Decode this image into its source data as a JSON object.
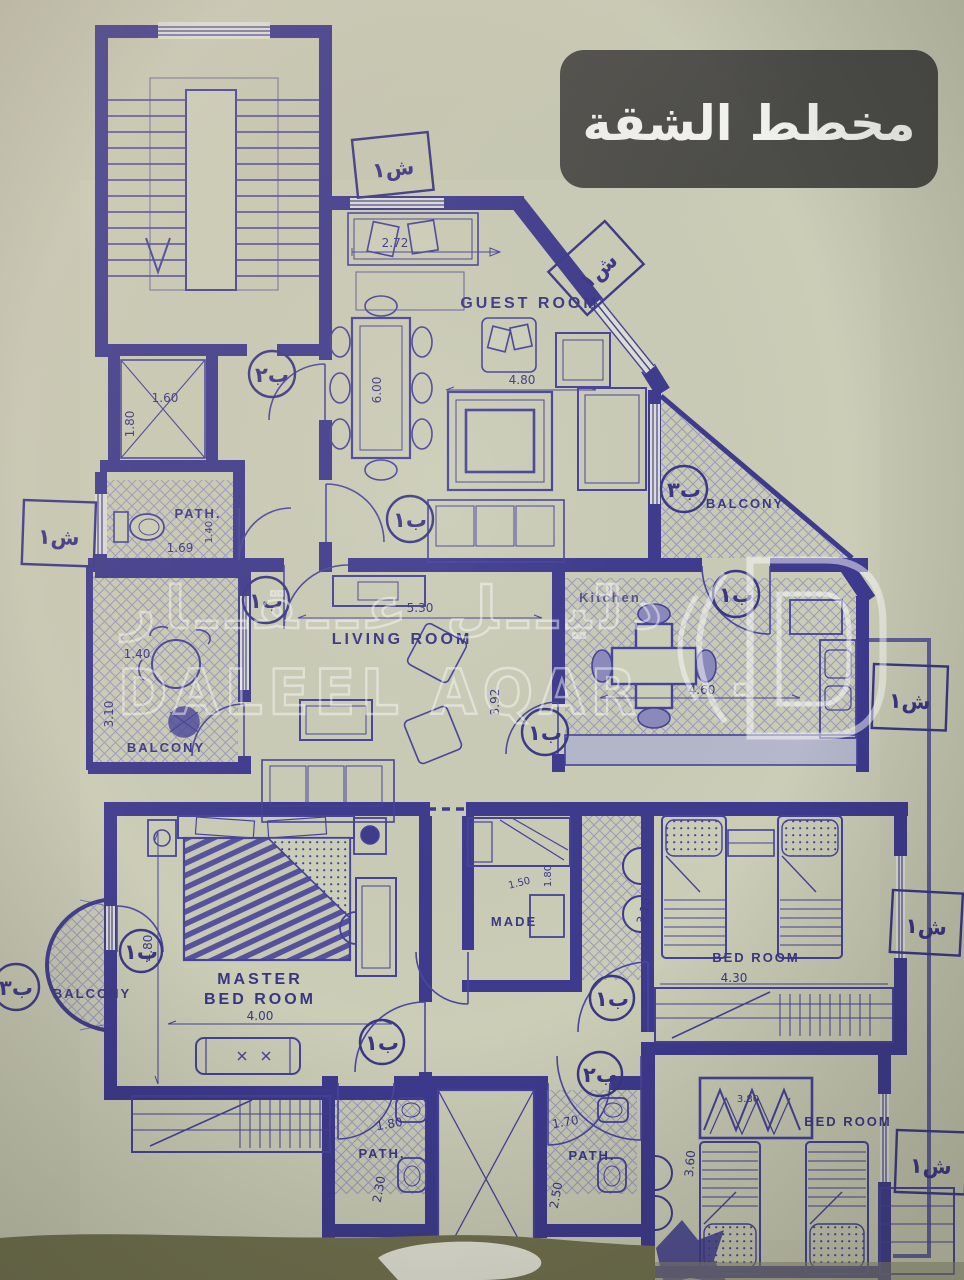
{
  "title": {
    "text": "مخطط الشقة"
  },
  "watermark": {
    "arabic": "دليــل عــقــار",
    "latin": "DALEEL AQAR"
  },
  "rooms": {
    "guest": "GUEST ROOM",
    "living": "LIVING ROOM",
    "kitchen": "Kitchen",
    "master_line1": "MASTER",
    "master_line2": "BED ROOM",
    "maid": "MADE",
    "bedroom": "BED ROOM",
    "bath": "PATH.",
    "balcony": "BALCONY"
  },
  "dims": {
    "guest_sofa": "2.72",
    "guest_table": "6.00",
    "guest_width": "4.80",
    "lift_depth": "1.80",
    "lift_width": "1.60",
    "wc_width": "1.69",
    "wc_depth": "1.40",
    "living_width": "5.30",
    "living_depth": "3.92",
    "balcony_left_width": "1.40",
    "balcony_left_depth": "3.10",
    "kitchen_width": "4.60",
    "master_width": "4.00",
    "master_depth": "4.80",
    "maid_width": "1.50",
    "maid_depth": "1.80",
    "corridor_depth": "3.10",
    "bedroom1_width": "4.30",
    "bath1_width": "1.80",
    "bath1_depth": "2.30",
    "bath2_width": "1.70",
    "bath2_depth": "2.50",
    "wardrobe2_width": "3.80",
    "bedroom2_depth": "3.60"
  },
  "markers": {
    "window": "ش١",
    "door1": "ب١",
    "door2": "ب٢",
    "door3": "ب٣"
  }
}
